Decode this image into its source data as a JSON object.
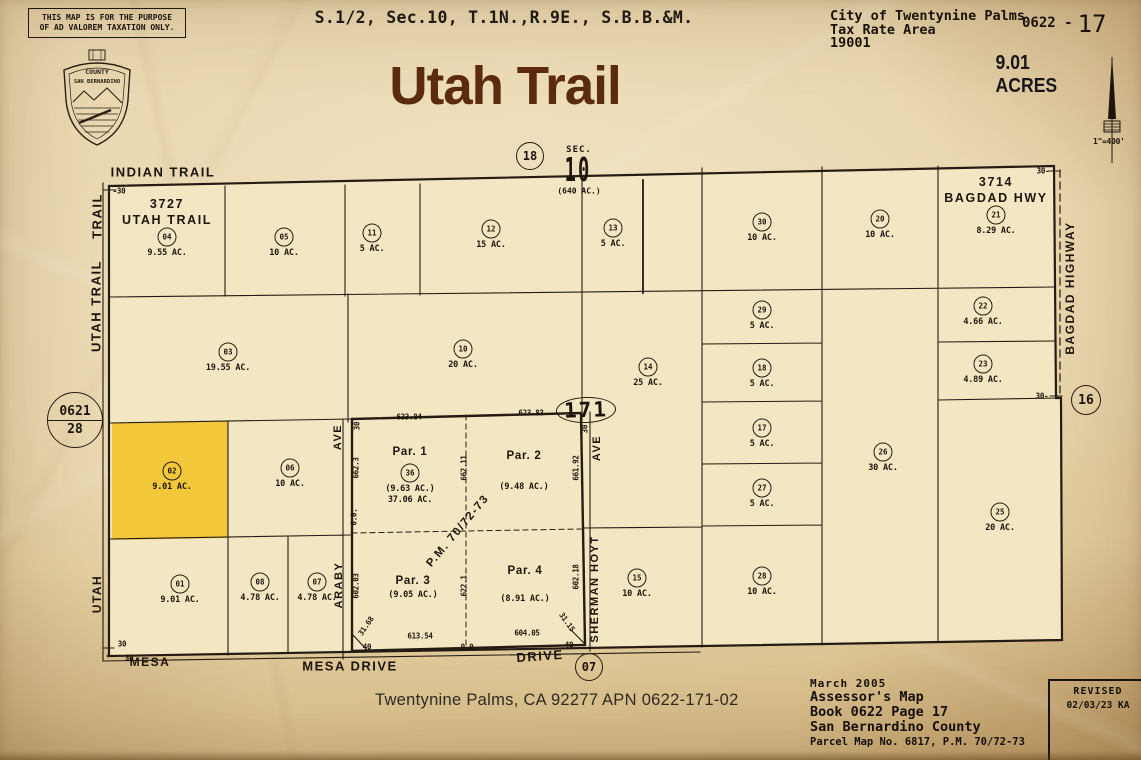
{
  "header": {
    "disclaimer_line1": "THIS MAP IS FOR THE PURPOSE",
    "disclaimer_line2": "OF AD VALOREM TAXATION ONLY.",
    "section_title": "S.1/2, Sec.10, T.1N.,R.9E., S.B.B.&M.",
    "map_title": "Utah Trail",
    "city_line1": "City of Twentynine Palms",
    "city_line2": "Tax Rate Area",
    "city_line3": "19001",
    "book_page_prefix": "0622 -",
    "book_page_number": "17",
    "acres": "9.01 ACRES",
    "scale": "1\"=400'"
  },
  "seal": {
    "top": "COUNTY",
    "name": "SAN BERNARDINO"
  },
  "map": {
    "sec": {
      "label": "SEC.",
      "number": "10",
      "acres": "(640 AC.)"
    },
    "refs": {
      "top": "18",
      "right": "16",
      "bottom": "07",
      "left_book": "0621",
      "left_page": "28",
      "block": "171"
    },
    "highlight_color": "#f3c73a",
    "parcels": [
      {
        "num": "04",
        "acres": "9.55 AC.",
        "x": 167,
        "y": 237,
        "tag1": "3727",
        "tag2": "UTAH TRAIL"
      },
      {
        "num": "05",
        "acres": "10 AC.",
        "x": 284,
        "y": 237
      },
      {
        "num": "11",
        "acres": "5 AC.",
        "x": 372,
        "y": 233
      },
      {
        "num": "12",
        "acres": "15 AC.",
        "x": 491,
        "y": 229
      },
      {
        "num": "13",
        "acres": "5 AC.",
        "x": 613,
        "y": 228
      },
      {
        "num": "30",
        "acres": "10 AC.",
        "x": 762,
        "y": 222
      },
      {
        "num": "20",
        "acres": "10 AC.",
        "x": 880,
        "y": 219
      },
      {
        "num": "21",
        "acres": "8.29 AC.",
        "x": 996,
        "y": 215,
        "tag1": "3714",
        "tag2": "BAGDAD HWY"
      },
      {
        "num": "03",
        "acres": "19.55 AC.",
        "x": 228,
        "y": 352
      },
      {
        "num": "10",
        "acres": "20 AC.",
        "x": 463,
        "y": 349
      },
      {
        "num": "14",
        "acres": "25 AC.",
        "x": 648,
        "y": 367
      },
      {
        "num": "29",
        "acres": "5 AC.",
        "x": 762,
        "y": 310
      },
      {
        "num": "18",
        "acres": "5 AC.",
        "x": 762,
        "y": 368
      },
      {
        "num": "22",
        "acres": "4.66 AC.",
        "x": 983,
        "y": 306
      },
      {
        "num": "23",
        "acres": "4.89 AC.",
        "x": 983,
        "y": 364
      },
      {
        "num": "17",
        "acres": "5 AC.",
        "x": 762,
        "y": 428
      },
      {
        "num": "27",
        "acres": "5 AC.",
        "x": 762,
        "y": 488
      },
      {
        "num": "26",
        "acres": "30 AC.",
        "x": 883,
        "y": 452
      },
      {
        "num": "02",
        "acres": "9.01 AC.",
        "x": 172,
        "y": 471,
        "hl": true
      },
      {
        "num": "06",
        "acres": "10 AC.",
        "x": 290,
        "y": 468
      },
      {
        "num": "25",
        "acres": "20 AC.",
        "x": 1000,
        "y": 512
      },
      {
        "num": "15",
        "acres": "10 AC.",
        "x": 637,
        "y": 578
      },
      {
        "num": "28",
        "acres": "10 AC.",
        "x": 762,
        "y": 576
      },
      {
        "num": "01",
        "acres": "9.01 AC.",
        "x": 180,
        "y": 584
      },
      {
        "num": "08",
        "acres": "4.78 AC.",
        "x": 260,
        "y": 582
      },
      {
        "num": "07",
        "acres": "4.78 AC.",
        "x": 317,
        "y": 582
      },
      {
        "num": "36",
        "acres": "",
        "x": 410,
        "y": 473
      }
    ],
    "par_labels": [
      {
        "t": "Par. 1",
        "x": 410,
        "y": 452,
        "k": "n"
      },
      {
        "t": "(9.63 AC.)",
        "x": 410,
        "y": 489,
        "k": "a"
      },
      {
        "t": "37.06 AC.",
        "x": 410,
        "y": 500,
        "k": "a"
      },
      {
        "t": "Par. 2",
        "x": 524,
        "y": 456,
        "k": "n"
      },
      {
        "t": "(9.48 AC.)",
        "x": 524,
        "y": 487,
        "k": "a"
      },
      {
        "t": "Par. 3",
        "x": 413,
        "y": 581,
        "k": "n"
      },
      {
        "t": "(9.05 AC.)",
        "x": 413,
        "y": 595,
        "k": "a"
      },
      {
        "t": "Par. 4",
        "x": 525,
        "y": 571,
        "k": "n"
      },
      {
        "t": "(8.91 AC.)",
        "x": 525,
        "y": 599,
        "k": "a"
      }
    ],
    "dims": [
      {
        "t": "633.84",
        "x": 409,
        "y": 417,
        "r": 0
      },
      {
        "t": "623.83",
        "x": 531,
        "y": 413,
        "r": 0
      },
      {
        "t": "662.11",
        "x": 464,
        "y": 468,
        "r": -90
      },
      {
        "t": "661.92",
        "x": 576,
        "y": 468,
        "r": -90
      },
      {
        "t": "662.3",
        "x": 356,
        "y": 468,
        "r": -90
      },
      {
        "t": "602.03",
        "x": 356,
        "y": 586,
        "r": -90
      },
      {
        "t": "622.1",
        "x": 464,
        "y": 586,
        "r": -90
      },
      {
        "t": "602.18",
        "x": 576,
        "y": 577,
        "r": -90
      },
      {
        "t": "613.54",
        "x": 420,
        "y": 636,
        "r": 0
      },
      {
        "t": "604.05",
        "x": 527,
        "y": 633,
        "r": 0
      },
      {
        "t": "31.68",
        "x": 366,
        "y": 626,
        "r": -55
      },
      {
        "t": "31.15",
        "x": 567,
        "y": 622,
        "r": 55
      },
      {
        "t": "0.0.",
        "x": 354,
        "y": 517,
        "r": -90
      },
      {
        "t": "-30",
        "x": 119,
        "y": 191,
        "r": 0
      },
      {
        "t": "30-",
        "x": 1043,
        "y": 171,
        "r": 0
      },
      {
        "t": "30-",
        "x": 1042,
        "y": 396,
        "r": 0
      },
      {
        "t": "30",
        "x": 122,
        "y": 644,
        "r": 0
      },
      {
        "t": "30",
        "x": 129,
        "y": 658,
        "r": 0
      },
      {
        "t": "30",
        "x": 357,
        "y": 426,
        "r": -90
      },
      {
        "t": "30",
        "x": 585,
        "y": 429,
        "r": -90
      },
      {
        "t": "40",
        "x": 367,
        "y": 647,
        "r": 0
      },
      {
        "t": "40",
        "x": 569,
        "y": 645,
        "r": 0
      },
      {
        "t": "0.0",
        "x": 467,
        "y": 647,
        "r": 0
      }
    ],
    "roads": [
      {
        "t": "INDIAN TRAIL",
        "x": 163,
        "y": 172,
        "r": 0,
        "s": 13
      },
      {
        "t": "TRAIL",
        "x": 97,
        "y": 216,
        "r": -90,
        "s": 13
      },
      {
        "t": "UTAH TRAIL",
        "x": 96,
        "y": 306,
        "r": -90,
        "s": 13
      },
      {
        "t": "UTAH",
        "x": 97,
        "y": 594,
        "r": -90,
        "s": 12
      },
      {
        "t": "AVE",
        "x": 338,
        "y": 437,
        "r": -90,
        "s": 11
      },
      {
        "t": "ARABY",
        "x": 339,
        "y": 585,
        "r": -90,
        "s": 11
      },
      {
        "t": "AVE",
        "x": 597,
        "y": 448,
        "r": -90,
        "s": 11
      },
      {
        "t": "SHERMAN HOYT",
        "x": 595,
        "y": 589,
        "r": -90,
        "s": 11
      },
      {
        "t": "BAGDAD HIGHWAY",
        "x": 1070,
        "y": 288,
        "r": -90,
        "s": 12
      },
      {
        "t": "MESA",
        "x": 150,
        "y": 662,
        "r": 0,
        "s": 12
      },
      {
        "t": "MESA DRIVE",
        "x": 350,
        "y": 666,
        "r": 0,
        "s": 13
      },
      {
        "t": "DRIVE",
        "x": 540,
        "y": 656,
        "r": -4,
        "s": 13
      },
      {
        "t": "P.M. 70/72-73",
        "x": 458,
        "y": 531,
        "r": -50,
        "s": 11.5
      }
    ]
  },
  "footer": {
    "address": "Twentynine Palms, CA  92277",
    "apn": "APN  0622-171-02",
    "date": "March 2005",
    "line1": "Assessor's Map",
    "line2": "Book 0622 Page 17",
    "line3": "San Bernardino County",
    "line4": "Parcel Map No. 6817, P.M. 70/72-73",
    "revised_label": "REVISED",
    "revised_date": "02/03/23 KA"
  }
}
